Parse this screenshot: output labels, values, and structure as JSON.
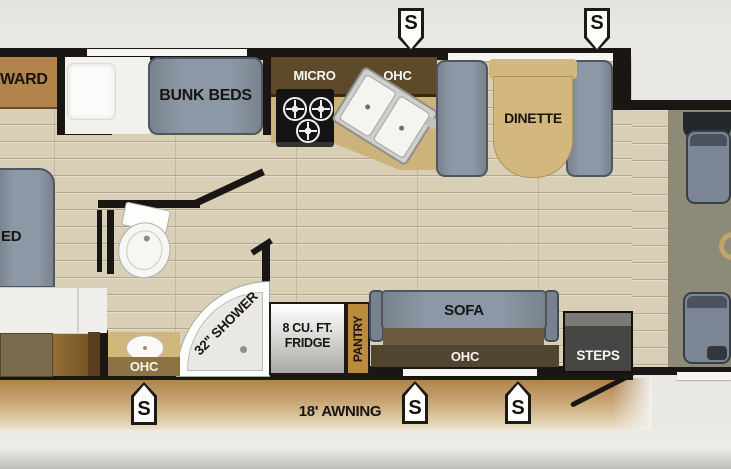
{
  "plan": {
    "type": "rv-floorplan",
    "speaker_label": "S",
    "bedroom": {
      "wardrobe_label": "WARD",
      "bunk_label": "BUNK BEDS",
      "bed_label": "ED"
    },
    "kitchen": {
      "micro_label": "MICRO",
      "ohc_label": "OHC"
    },
    "dinette": {
      "label": "DINETTE"
    },
    "bathroom": {
      "shower_label": "32\" SHOWER",
      "vanity_ohc_label": "OHC"
    },
    "galley": {
      "fridge_line1": "8 CU. FT.",
      "fridge_line2": "FRIDGE",
      "pantry_label": "PANTRY"
    },
    "living": {
      "sofa_label": "SOFA",
      "ohc_label": "OHC"
    },
    "entry": {
      "steps_label": "STEPS"
    },
    "exterior": {
      "awning_label": "18' AWNING"
    },
    "colors": {
      "wall": "#1a1613",
      "floor_plank": "#d8cfb6",
      "cab_floor": "#8e8a78",
      "furniture_gray": "#8c98a5",
      "table_tan": "#d2b87d",
      "cabinet_dark_brown": "#5e4a2a",
      "wardrobe_tan": "#b2834b",
      "pantry_orange": "#bb8b3d",
      "awning_tan": "#c6a271",
      "sofa_seat_brown": "#6d5a40"
    }
  }
}
